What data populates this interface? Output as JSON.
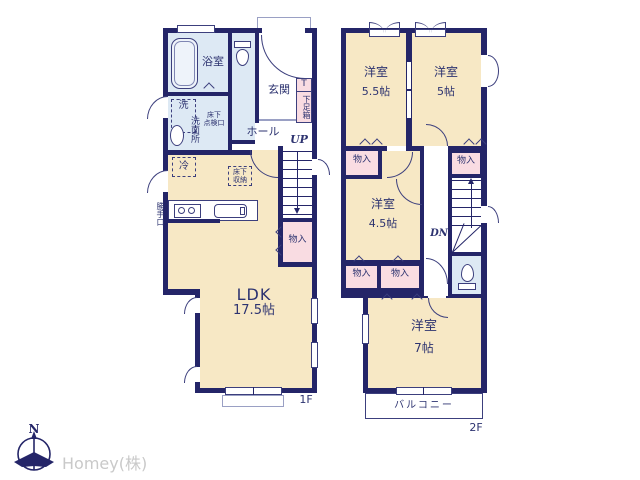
{
  "colors": {
    "wall_navy": "#242568",
    "room_cream": "#f7e8c5",
    "wet_area_blue": "#dde9f4",
    "closet_pink": "#f9dce2",
    "text_navy": "#2d3370",
    "logo_gray": "#c9c9c9"
  },
  "floor1": {
    "label": "1F",
    "bathroom": "浴室",
    "washer": "洗",
    "washroom": "洗面所",
    "hatch_line1": "床下",
    "hatch_line2": "点検口",
    "entrance": "玄関",
    "shoebox_top": "T",
    "shoebox": "下足箱",
    "hall": "ホール",
    "stairs": "UP",
    "closet": "物入",
    "fridge": "冷",
    "storage_line1": "床下",
    "storage_line2": "収納",
    "backdoor": "勝手口",
    "ldk_name": "LDK",
    "ldk_size": "17.5帖"
  },
  "floor2": {
    "label": "2F",
    "bedroom_tl_name": "洋室",
    "bedroom_tl_size": "5.5帖",
    "bedroom_tr_name": "洋室",
    "bedroom_tr_size": "5帖",
    "bedroom_mid_name": "洋室",
    "bedroom_mid_size": "4.5帖",
    "bedroom_bottom_name": "洋室",
    "bedroom_bottom_size": "7帖",
    "closet_top_left": "物入",
    "closet_top_right": "物入",
    "closet_mid_left": "物入",
    "closet_mid_center": "物入",
    "stairs": "DN",
    "balcony": "バルコニー"
  },
  "footer": {
    "compass_north": "N",
    "company": "Homey(株)"
  }
}
